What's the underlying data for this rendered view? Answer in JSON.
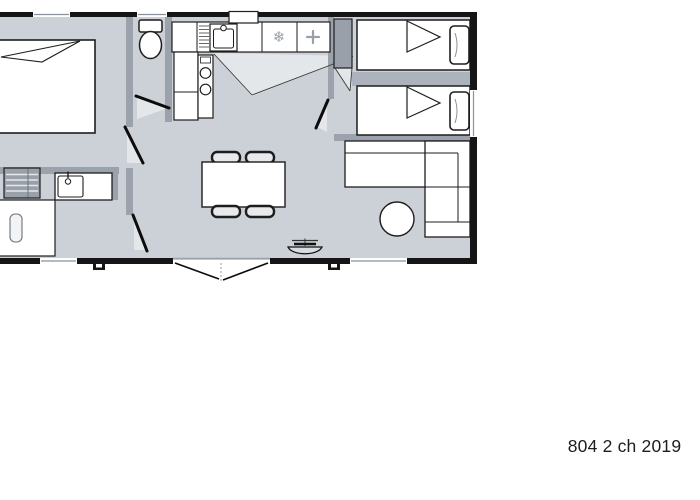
{
  "caption": {
    "text": "804 2 ch 2019"
  },
  "icons": {
    "freezer_glyph": "❄",
    "hob_cross_glyph": "+"
  },
  "palette": {
    "wall": "#151515",
    "partition": "#9ba2ac",
    "floor": "#ccd1d8",
    "light_wedge": "#e4e7ea",
    "furniture_outline": "#1d1d1d",
    "cabinet_fill": "#99a0aa",
    "window_line": "#8b929b",
    "symbol_gray": "#9aa0a8"
  }
}
